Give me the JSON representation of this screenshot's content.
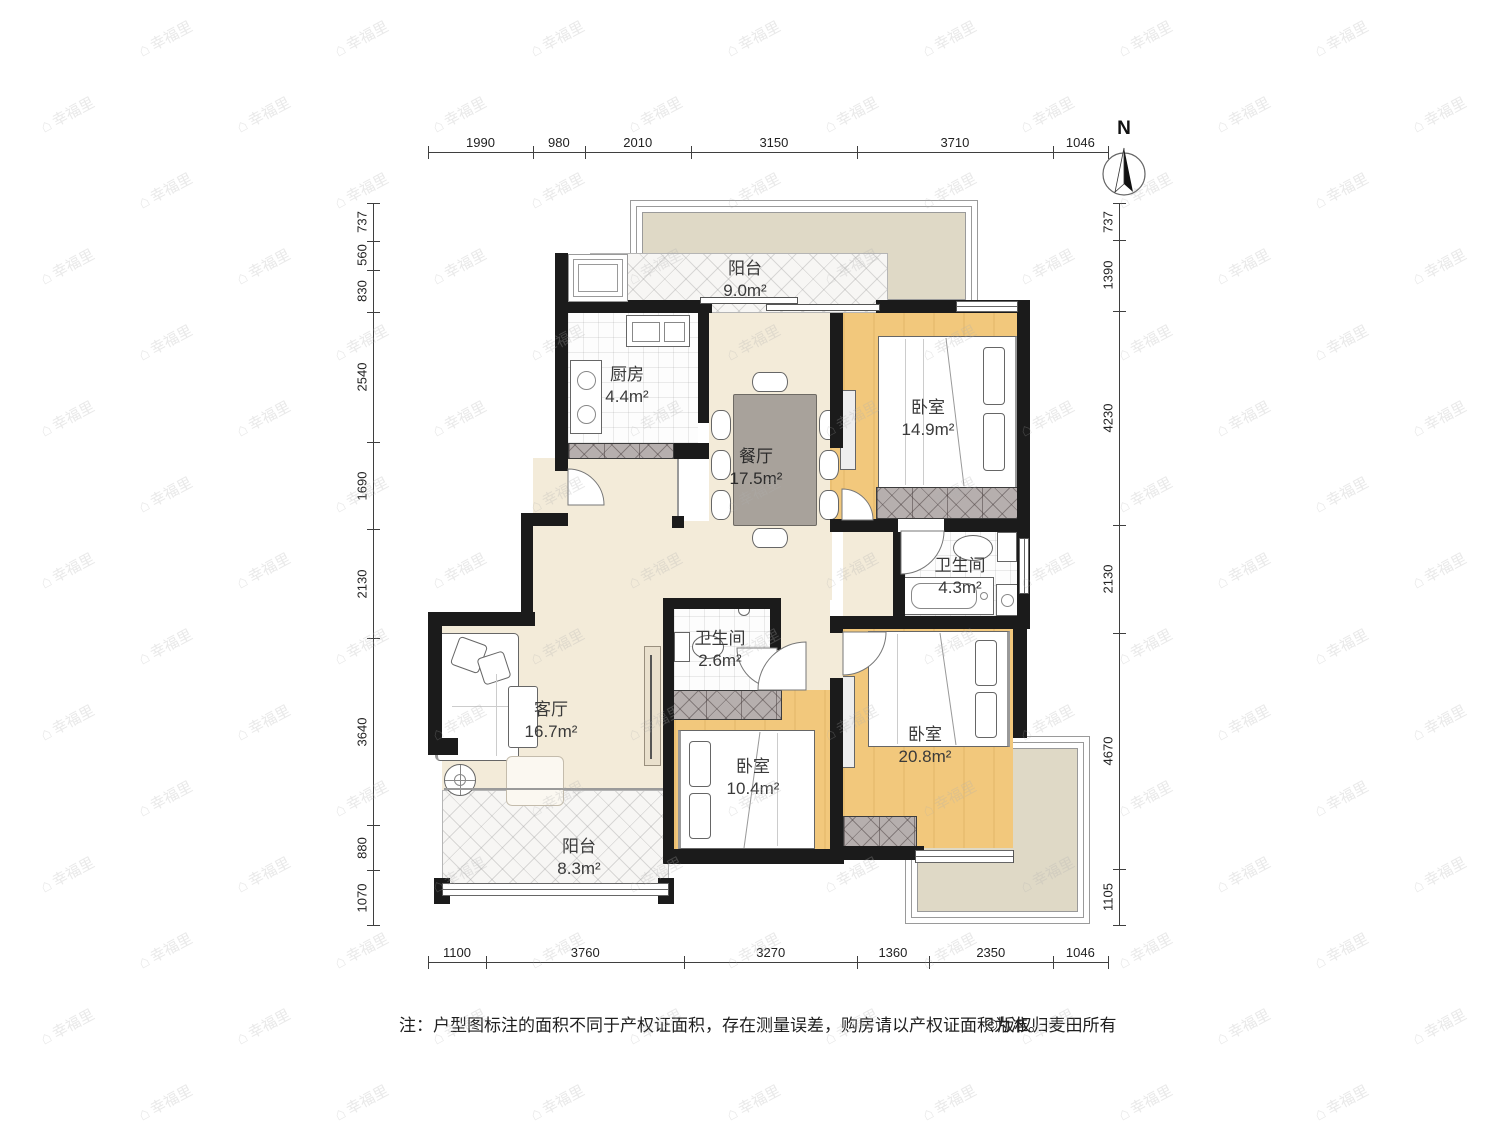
{
  "compass": {
    "label": "N"
  },
  "watermark": {
    "text": "幸福里",
    "icon": "house-icon"
  },
  "note": {
    "text": "注：户型图标注的面积不同于产权证面积，存在测量误差，购房请以产权证面积为准。",
    "copyright": "©版权归麦田所有"
  },
  "rooms": {
    "balcony_top": {
      "name": "阳台",
      "area": "9.0m²"
    },
    "kitchen": {
      "name": "厨房",
      "area": "4.4m²"
    },
    "dining": {
      "name": "餐厅",
      "area": "17.5m²"
    },
    "bedroom_top_right": {
      "name": "卧室",
      "area": "14.9m²"
    },
    "bathroom_main": {
      "name": "卫生间",
      "area": "4.3m²"
    },
    "bathroom_small": {
      "name": "卫生间",
      "area": "2.6m²"
    },
    "living": {
      "name": "客厅",
      "area": "16.7m²"
    },
    "bedroom_bottom_mid": {
      "name": "卧室",
      "area": "10.4m²"
    },
    "bedroom_bottom_right": {
      "name": "卧室",
      "area": "20.8m²"
    },
    "balcony_bottom": {
      "name": "阳台",
      "area": "8.3m²"
    }
  },
  "dimensions": {
    "top": [
      "1990",
      "980",
      "2010",
      "3150",
      "3710",
      "1046"
    ],
    "bottom": [
      "1100",
      "3760",
      "3270",
      "1360",
      "2350",
      "1046"
    ],
    "left": [
      "737",
      "560",
      "830",
      "2540",
      "1690",
      "2130",
      "3640",
      "880",
      "1070"
    ],
    "right": [
      "737",
      "1390",
      "4230",
      "2130",
      "4670",
      "1105"
    ]
  },
  "colors": {
    "wall": "#1b1b1b",
    "beige_floor": "#f3ebd9",
    "orange_floor": "#f2c87c",
    "terrace": "#dfd9c6"
  }
}
